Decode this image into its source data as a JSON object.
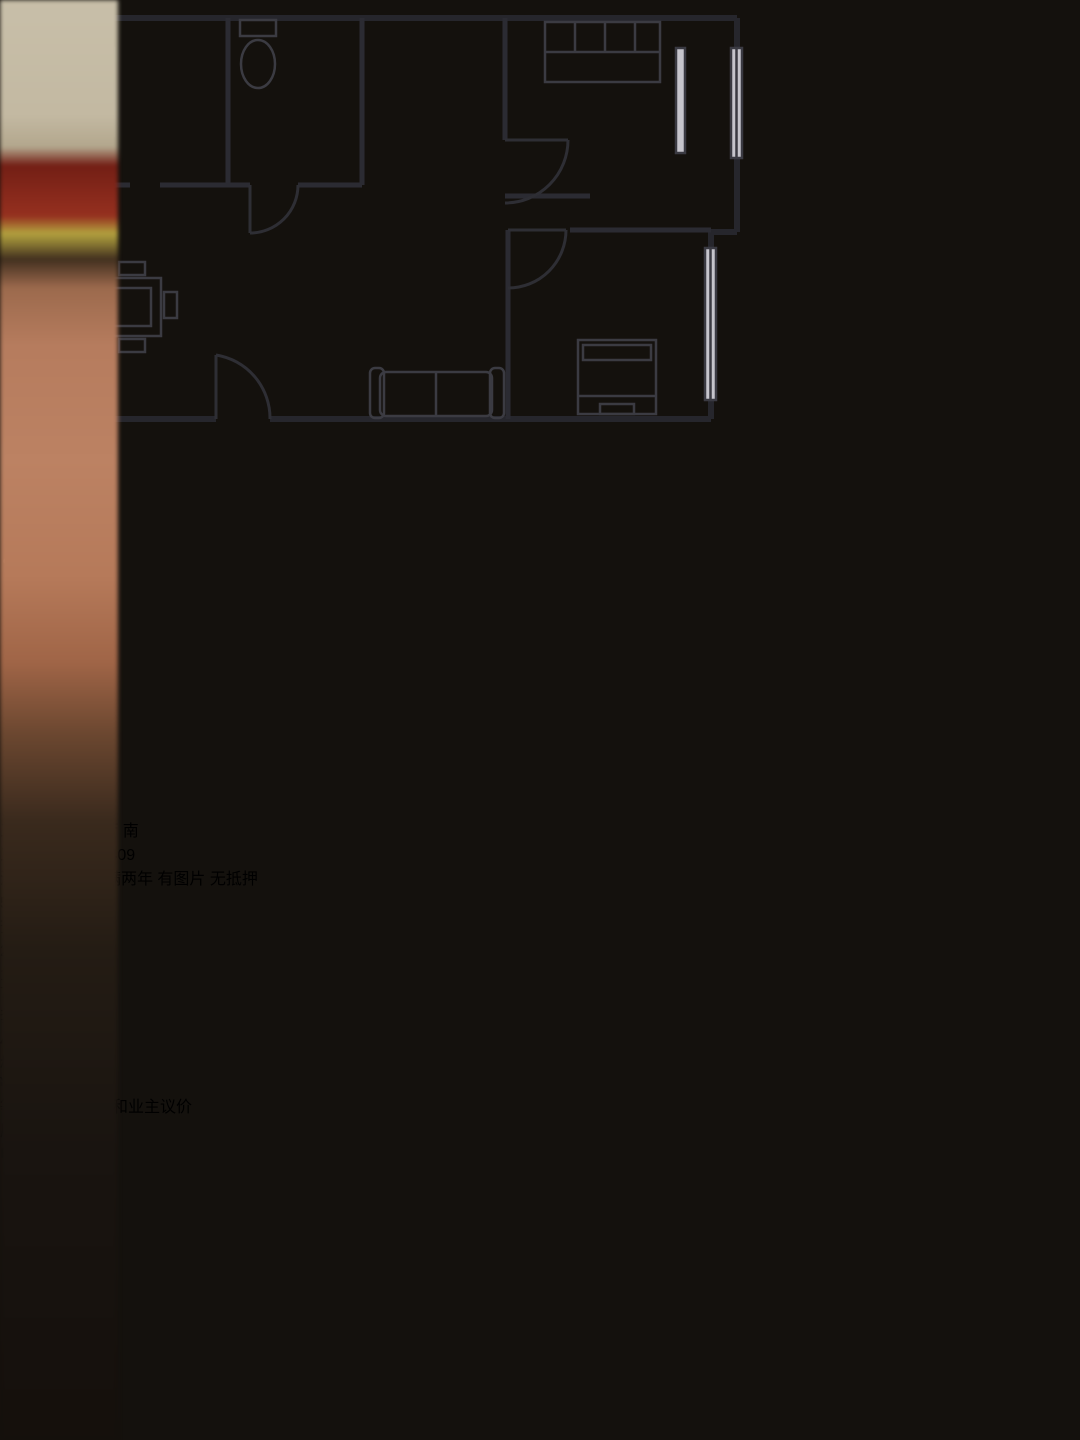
{
  "status_bar": {
    "notification_icon_colors": [
      "#b5722e",
      "#4e8f4e",
      "#66755f",
      "#23406e",
      "#1e56c8"
    ]
  },
  "icons": {
    "back": "chevron-left",
    "compass": "up-arrow",
    "favorite": "heart-outline",
    "share": "box-with-arrow",
    "negotiate_bubble": "¥",
    "floor_price_info": "!"
  },
  "listing": {
    "title": "三化二村 2室2厅 南",
    "address": "三化二村-27幢-409",
    "badge": "淘宝池",
    "tags": [
      "可落户",
      "满两年",
      "有图片",
      "无抵押"
    ],
    "price": {
      "value": "51",
      "unit": "万"
    },
    "floor_price_label": "查看底价",
    "stats": [
      {
        "value": "2室2厅1卫",
        "label": "1厨1阳"
      },
      {
        "value": "76m²",
        "label": "套内73.00m²"
      },
      {
        "value": "4/6层",
        "label": "楼层"
      }
    ]
  },
  "bottom_bar": {
    "yuan_icon": "¥",
    "hint": "等待降价？试试和业主议价",
    "history_button": "历史价格",
    "apply_button": "申请调价"
  },
  "colors": {
    "badge_green": "#56b18c",
    "price_red": "#dd5f48",
    "link_orange": "#dd7a50",
    "cta_khaki": "#a18a52"
  }
}
